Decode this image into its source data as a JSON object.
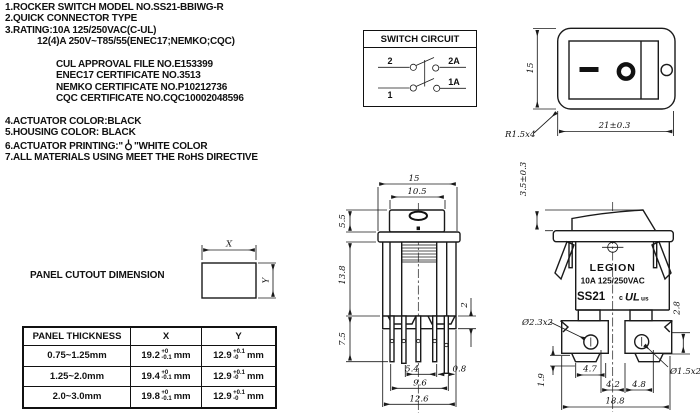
{
  "notes": {
    "l1": "1.ROCKER SWITCH MODEL NO.SS21-BBIWG-R",
    "l2": "2.QUICK CONNECTOR TYPE",
    "l3": "3.RATING:10A 125/250VAC(C-UL)",
    "l4": "12(4)A 250V~T85/55(ENEC17;NEMKO;CQC)",
    "cert1": "CUL APPROVAL FILE NO.E153399",
    "cert2": "ENEC17 CERTIFICATE NO.3513",
    "cert3": "NEMKO CERTIFICATE NO.P10212736",
    "cert4": "CQC CERTIFICATE NO.CQC10002048596",
    "l5": "4.ACTUATOR COLOR:BLACK",
    "l6": "5.HOUSING COLOR: BLACK",
    "l7a": "6.ACTUATOR PRINTING:\"",
    "l7b": "\"WHITE COLOR",
    "l8": "7.ALL MATERIALS USING MEET THE RoHS DIRECTIVE"
  },
  "circuit": {
    "title": "SWITCH CIRCUIT",
    "t_top_left": "2",
    "t_top_right": "2A",
    "t_bottom_left": "1",
    "t_bottom_right": "1A"
  },
  "front_view": {
    "dim_height": "15",
    "dim_width": "21±0.3",
    "radius_label": "R1.5x4",
    "mark_on": "—",
    "mark_off": "O"
  },
  "main_view": {
    "dim_width": "15",
    "dim_actuator_w": "10.5",
    "dim_actuator_h": "5.5",
    "dim_body_h": "13.8",
    "dim_pin_len": "7.5",
    "dim_step": "2",
    "dim_span_inner": "5.4",
    "dim_span_mid": "9.6",
    "dim_span_outer": "12.6",
    "dim_pin_thk": "0.8"
  },
  "side_view": {
    "dim_rocker_h": "3.5±0.3",
    "brand": "LEGION",
    "rating": "10A 125/250VAC",
    "model": "SS21",
    "ul_prefix": "c",
    "ul_mark": "UL",
    "ul_suffix": "us",
    "dim_hole_left": "Ø2.3x2",
    "dim_hole_right": "Ø1.5x2",
    "dim_foot_w": "4.7",
    "dim_hole_to_center_l": "4.2",
    "dim_hole_to_center_r": "4.8",
    "dim_total_w": "18.8",
    "dim_foot_h": "1.9",
    "dim_hole_pos": "2.8"
  },
  "cutout": {
    "title": "PANEL CUTOUT DIMENSION",
    "x_label": "X",
    "y_label": "Y"
  },
  "table": {
    "headers": {
      "thickness": "PANEL THICKNESS",
      "x": "X",
      "y": "Y"
    },
    "rows": [
      {
        "thickness": "0.75~1.25mm",
        "x_val": "19.2",
        "x_tol_top": "+0",
        "x_tol_bot": "-0.1",
        "x_unit": "mm",
        "y_val": "12.9",
        "y_tol_top": "+0.1",
        "y_tol_bot": "-0",
        "y_unit": "mm"
      },
      {
        "thickness": "1.25~2.0mm",
        "x_val": "19.4",
        "x_tol_top": "+0",
        "x_tol_bot": "-0.1",
        "x_unit": "mm",
        "y_val": "12.9",
        "y_tol_top": "+0.1",
        "y_tol_bot": "-0",
        "y_unit": "mm"
      },
      {
        "thickness": "2.0~3.0mm",
        "x_val": "19.8",
        "x_tol_top": "+0",
        "x_tol_bot": "-0.1",
        "x_unit": "mm",
        "y_val": "12.9",
        "y_tol_top": "+0.1",
        "y_tol_bot": "-0",
        "y_unit": "mm"
      }
    ]
  }
}
